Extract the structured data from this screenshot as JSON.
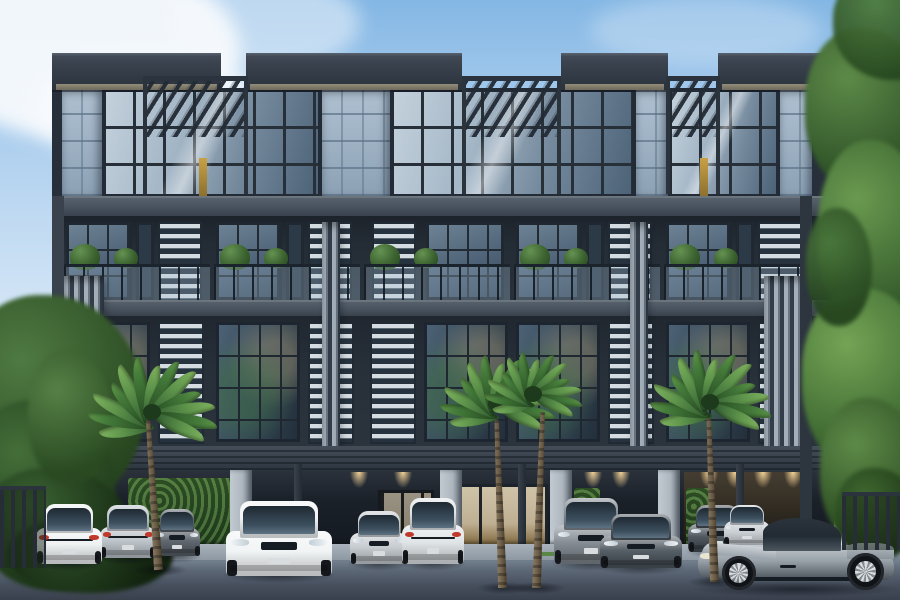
{
  "scene": {
    "width": 900,
    "height": 600,
    "alt": "Dusk architectural rendering of a modern four-storey grey townhouse block with glass curtain walls, louvre screens, roof pergolas, palm trees, hedges and luxury cars parked on the street in front"
  },
  "palette": {
    "sky_top": "#84b7e4",
    "sky_bottom": "#eef4fa",
    "cloud": "#f7fafd",
    "fascia": "#39424d",
    "soffit": "#938c79",
    "stone": "#9cb0c2",
    "frame": "#232c36",
    "glass_light": "#c4d1dc",
    "glass_dark": "#37485a",
    "louver_light": "#d4dce2",
    "louver_dark": "#26323d",
    "fin_light": "#a3aeb9",
    "fin_dark": "#333d49",
    "slab": "#4c5662",
    "ground_dark": "#121720",
    "pier": "#aeb7bf",
    "hedge": "#42652f",
    "palm_light": "#7fb35f",
    "palm_dark": "#2c5a30",
    "trunk": "#6b5d48",
    "warm_light": "#ffdb9c",
    "door_warm": "#bfb093",
    "street": "#5d6877",
    "apron": "#9aa4ae",
    "fence": "#262d36",
    "car_white": "#f0f3f4",
    "car_silver": "#c2c8cc",
    "car_gray": "#939ca4",
    "car_dark": "#49525a",
    "taillight": "#c0392b"
  },
  "sky": {
    "clouds": [
      {
        "x": -70,
        "y": -40,
        "w": 310,
        "h": 180,
        "o": 0.95
      },
      {
        "x": 30,
        "y": 50,
        "w": 240,
        "h": 115,
        "o": 0.8
      },
      {
        "x": 170,
        "y": -25,
        "w": 190,
        "h": 95,
        "o": 0.5
      },
      {
        "x": 590,
        "y": -5,
        "w": 230,
        "h": 70,
        "o": 0.28
      }
    ]
  },
  "trees": {
    "left": [
      {
        "x": -45,
        "y": 295,
        "w": 190,
        "h": 215,
        "c1": "#4f7a42",
        "c2": "#27451f",
        "o": 1
      },
      {
        "x": -35,
        "y": 400,
        "w": 150,
        "h": 175,
        "c1": "#446e39",
        "c2": "#1f3a1a",
        "o": 1
      },
      {
        "x": -20,
        "y": 468,
        "w": 150,
        "h": 122,
        "c1": "#3a6132",
        "c2": "#182e14",
        "o": 1
      },
      {
        "x": 28,
        "y": 350,
        "w": 84,
        "h": 135,
        "c1": "#578247",
        "c2": "#2a4a22",
        "o": 0.95
      },
      {
        "x": 8,
        "y": 518,
        "w": 165,
        "h": 75,
        "c1": "#2c4c26",
        "c2": "#12230f",
        "o": 1
      }
    ],
    "right": [
      {
        "x": 805,
        "y": 28,
        "w": 120,
        "h": 165,
        "c1": "#5d8a48",
        "c2": "#2c4f26",
        "o": 1
      },
      {
        "x": 818,
        "y": 140,
        "w": 112,
        "h": 195,
        "c1": "#6a9a50",
        "c2": "#315829",
        "o": 1
      },
      {
        "x": 802,
        "y": 288,
        "w": 128,
        "h": 185,
        "c1": "#74a455",
        "c2": "#35602c",
        "o": 1
      },
      {
        "x": 820,
        "y": 398,
        "w": 102,
        "h": 152,
        "c1": "#5d8a48",
        "c2": "#28481f",
        "o": 1
      },
      {
        "x": 836,
        "y": 468,
        "w": 82,
        "h": 92,
        "c1": "#3f682f",
        "c2": "#1b3315",
        "o": 1
      },
      {
        "x": 833,
        "y": -32,
        "w": 122,
        "h": 112,
        "c1": "#4f7d3f",
        "c2": "#24431d",
        "o": 0.95
      },
      {
        "x": 806,
        "y": 208,
        "w": 66,
        "h": 118,
        "c1": "#49763b",
        "c2": "#22401c",
        "o": 0.9
      }
    ]
  },
  "building": {
    "x": 52,
    "w": 782,
    "top": 53,
    "bottom": 556,
    "roof_y": [
      53,
      37
    ],
    "roof_boxes": [
      [
        52,
        221
      ],
      [
        246,
        462
      ],
      [
        561,
        668
      ],
      [
        718,
        833
      ]
    ],
    "pergola_y": [
      76,
      56
    ],
    "pergolas": [
      [
        143,
        248
      ],
      [
        462,
        561
      ],
      [
        666,
        720
      ]
    ],
    "top_floor": {
      "y": [
        88,
        110
      ],
      "stone": [
        [
          62,
          102
        ],
        [
          322,
          390
        ],
        [
          636,
          668
        ],
        [
          780,
          812
        ]
      ],
      "windows": [
        [
          102,
          322
        ],
        [
          390,
          636
        ],
        [
          668,
          780
        ]
      ],
      "warm": [
        [
          199,
          207
        ],
        [
          700,
          708
        ]
      ]
    },
    "slab1": [
      196,
      20
    ],
    "slab2": [
      300,
      16
    ],
    "carport_slab": [
      446,
      24
    ],
    "bays": [
      62,
      212,
      362,
      512,
      662
    ],
    "bay_w": 150,
    "floor2_y": [
      216,
      100
    ],
    "floor3_y": [
      316,
      130
    ],
    "fins_tall": {
      "x": [
        [
          64,
          104
        ],
        [
          764,
          808
        ]
      ],
      "y": [
        276,
        188
      ]
    },
    "fins_thin": {
      "x": [
        [
          322,
          340
        ],
        [
          630,
          648
        ]
      ],
      "y": [
        222,
        226
      ]
    },
    "ground": {
      "y": [
        470,
        86
      ],
      "warm_wall": [
        684,
        124,
        472,
        76
      ],
      "hedges": [
        [
          128,
          104,
          478,
          76
        ],
        [
          574,
          26,
          488,
          62
        ],
        [
          686,
          26,
          488,
          62
        ]
      ],
      "doors": [
        [
          456,
          92,
          484,
          72
        ],
        [
          378,
          56,
          490,
          66
        ]
      ],
      "piers": [
        [
          230,
          22
        ],
        [
          440,
          22
        ],
        [
          550,
          22
        ],
        [
          658,
          22
        ]
      ],
      "cols": [
        [
          294,
          8
        ],
        [
          518,
          8
        ],
        [
          736,
          8
        ]
      ],
      "lights": [
        350,
        394,
        584,
        612,
        700,
        726,
        754,
        784
      ]
    },
    "edge": {
      "left": [
        52,
        12
      ],
      "right": [
        800,
        12
      ],
      "y": [
        196,
        360
      ]
    }
  },
  "palms": [
    {
      "cx": 152,
      "cy": 412,
      "r": 66,
      "bx": 158,
      "by": 570,
      "len": 150,
      "lean": -4
    },
    {
      "cx": 497,
      "cy": 404,
      "r": 58,
      "bx": 502,
      "by": 588,
      "len": 168,
      "lean": -2
    },
    {
      "cx": 533,
      "cy": 394,
      "r": 50,
      "bx": 536,
      "by": 588,
      "len": 176,
      "lean": 2
    },
    {
      "cx": 710,
      "cy": 402,
      "r": 62,
      "bx": 714,
      "by": 582,
      "len": 164,
      "lean": -2
    }
  ],
  "fences": {
    "left": {
      "x": 0,
      "y": 486,
      "w": 46,
      "h": 82
    },
    "right": {
      "x": 842,
      "y": 492,
      "w": 58,
      "h": 58
    }
  },
  "street": {
    "top": 548,
    "apron": {
      "x": 58,
      "y": 544,
      "w": 766,
      "h": 16
    },
    "curb_marks": [
      [
        380,
        552,
        60,
        5
      ],
      [
        536,
        552,
        26,
        4
      ]
    ]
  },
  "cars": [
    {
      "name": "car-white-sedan-rear",
      "view": "rear",
      "x": 36,
      "y": 500,
      "w": 66,
      "h": 64,
      "c": "#edf0f1",
      "z": 5
    },
    {
      "name": "car-silver-sedan",
      "view": "rear",
      "x": 100,
      "y": 502,
      "w": 56,
      "h": 56,
      "c": "#b7bfc6",
      "z": 4
    },
    {
      "name": "car-dark-sedan",
      "view": "front",
      "x": 154,
      "y": 506,
      "w": 46,
      "h": 50,
      "c": "#545c64",
      "z": 4
    },
    {
      "name": "car-white-bmw",
      "view": "front",
      "x": 226,
      "y": 496,
      "w": 106,
      "h": 80,
      "c": "#f0f3f4",
      "z": 7
    },
    {
      "name": "car-silver-coupe",
      "view": "front",
      "x": 350,
      "y": 508,
      "w": 58,
      "h": 56,
      "c": "#c2c8cc",
      "z": 5
    },
    {
      "name": "car-white-suv-rear",
      "view": "rear",
      "x": 402,
      "y": 494,
      "w": 62,
      "h": 70,
      "c": "#dde2e5",
      "z": 6
    },
    {
      "name": "car-gray-suv",
      "view": "front",
      "x": 554,
      "y": 494,
      "w": 74,
      "h": 70,
      "c": "#7b838b",
      "z": 5
    },
    {
      "name": "car-dark-coupe",
      "view": "front",
      "x": 600,
      "y": 510,
      "w": 82,
      "h": 58,
      "c": "#49525a",
      "z": 6
    },
    {
      "name": "car-dark-sedan-2",
      "view": "front",
      "x": 688,
      "y": 502,
      "w": 58,
      "h": 50,
      "c": "#424a52",
      "z": 5
    },
    {
      "name": "car-silver-roadster",
      "view": "front",
      "x": 724,
      "y": 502,
      "w": 46,
      "h": 44,
      "c": "#c6cbd0",
      "z": 5
    },
    {
      "name": "car-gray-sports-side",
      "view": "side",
      "x": 698,
      "y": 492,
      "w": 196,
      "h": 98,
      "c": "#939ca4",
      "z": 8
    }
  ]
}
